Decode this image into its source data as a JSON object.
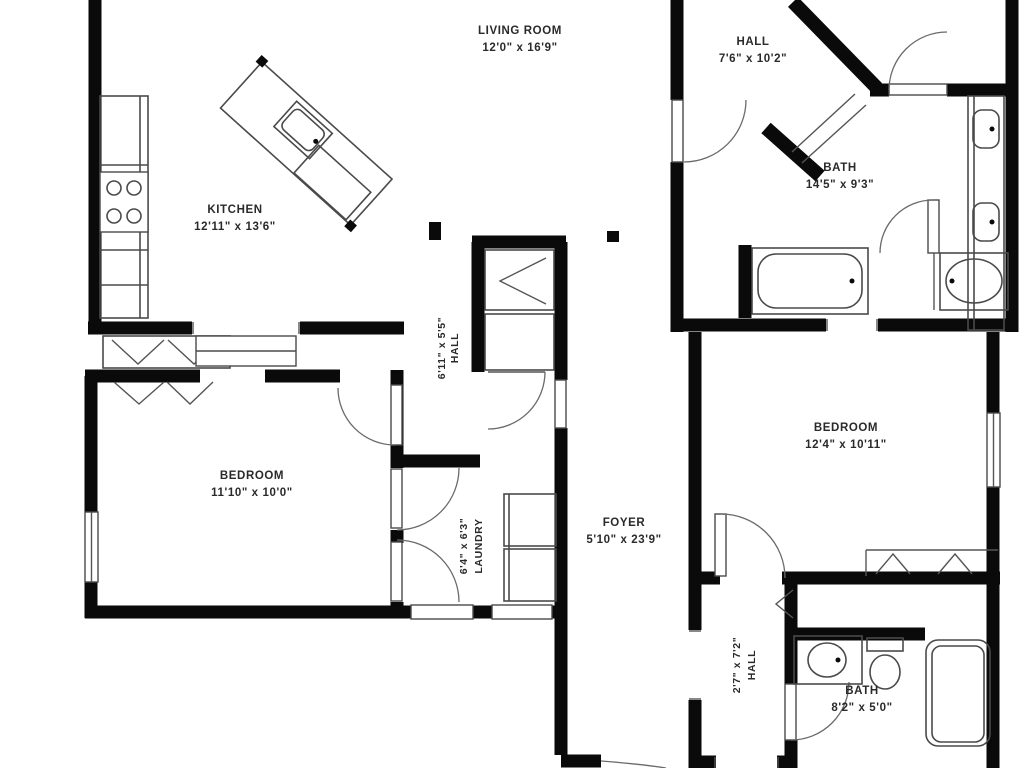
{
  "plan_title": "Apartment Floor Plan",
  "colors": {
    "wall": "#0a0a0a",
    "fixture": "#4a4a4a",
    "text": "#2a2a2a",
    "background": "#ffffff"
  },
  "rooms": {
    "living": {
      "name": "LIVING ROOM",
      "dims": "12'0\" x 16'9\""
    },
    "hall_top": {
      "name": "HALL",
      "dims": "7'6\" x 10'2\""
    },
    "kitchen": {
      "name": "KITCHEN",
      "dims": "12'11\" x 13'6\""
    },
    "bath_top": {
      "name": "BATH",
      "dims": "14'5\" x 9'3\""
    },
    "bedroom_left": {
      "name": "BEDROOM",
      "dims": "11'10\" x 10'0\""
    },
    "bedroom_right": {
      "name": "BEDROOM",
      "dims": "12'4\" x 10'11\""
    },
    "foyer": {
      "name": "FOYER",
      "dims": "5'10\" x 23'9\""
    },
    "bath_bottom": {
      "name": "BATH",
      "dims": "8'2\" x 5'0\""
    },
    "hall_center": {
      "name": "HALL",
      "dims": "6'11\" x 5'5\""
    },
    "laundry": {
      "name": "LAUNDRY",
      "dims": "6'4\" x 6'3\""
    },
    "hall_bottom": {
      "name": "HALL",
      "dims": "2'7\" x 7'2\""
    }
  }
}
